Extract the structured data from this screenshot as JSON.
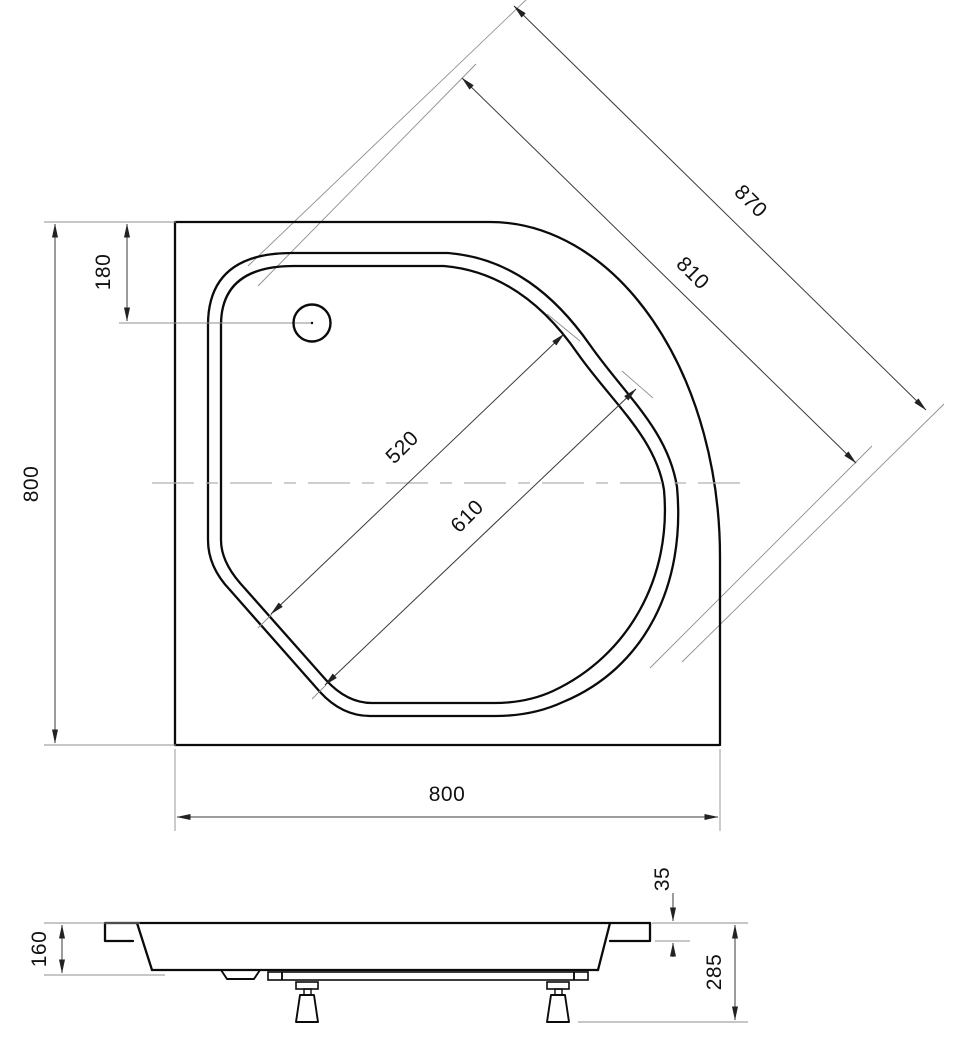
{
  "drawing": {
    "top_view": {
      "dim_height_left": "800",
      "dim_drain_offset": "180",
      "dim_diagonal_outer": "870",
      "dim_diagonal_rim": "810",
      "dim_basin_floor_diagonal": "520",
      "dim_basin_rim_diagonal": "610",
      "dim_width_bottom": "800"
    },
    "side_view": {
      "dim_body_height": "160",
      "dim_rim_lip_height": "35",
      "dim_total_height": "285"
    }
  }
}
